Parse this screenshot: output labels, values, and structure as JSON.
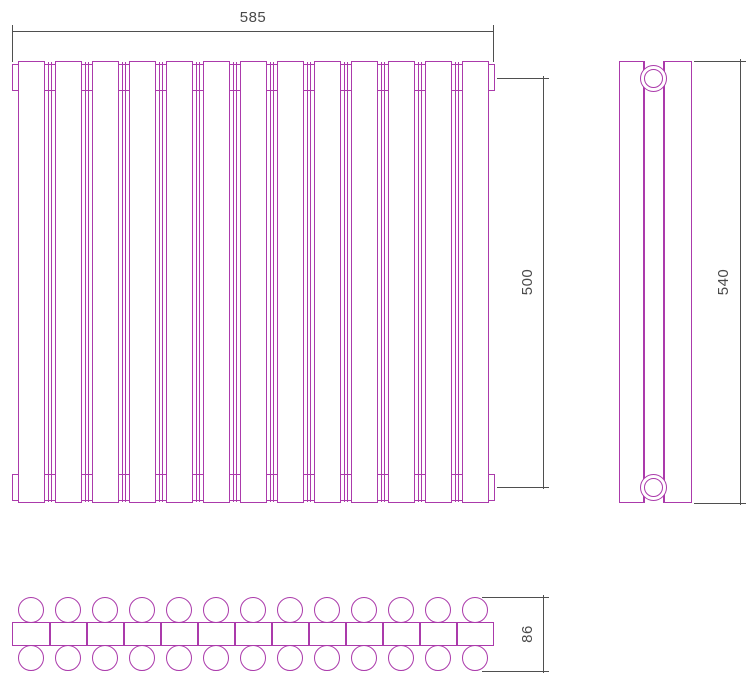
{
  "drawing": {
    "type": "technical-drawing",
    "subject": "sectional tubular radiator, three orthographic views",
    "line_color": "#ab3aab",
    "dimension_color": "#4f4f4f",
    "background": "#ffffff"
  },
  "dimensions": {
    "width": "585",
    "axis_height": "500",
    "overall_height": "540",
    "depth": "86"
  },
  "views": {
    "front": {
      "label": "front-view",
      "section_count": 13
    },
    "side": {
      "label": "side-view",
      "connection_count": 2
    },
    "plan": {
      "label": "top-view",
      "tube_rows": 2,
      "tubes_per_row": 13
    }
  }
}
